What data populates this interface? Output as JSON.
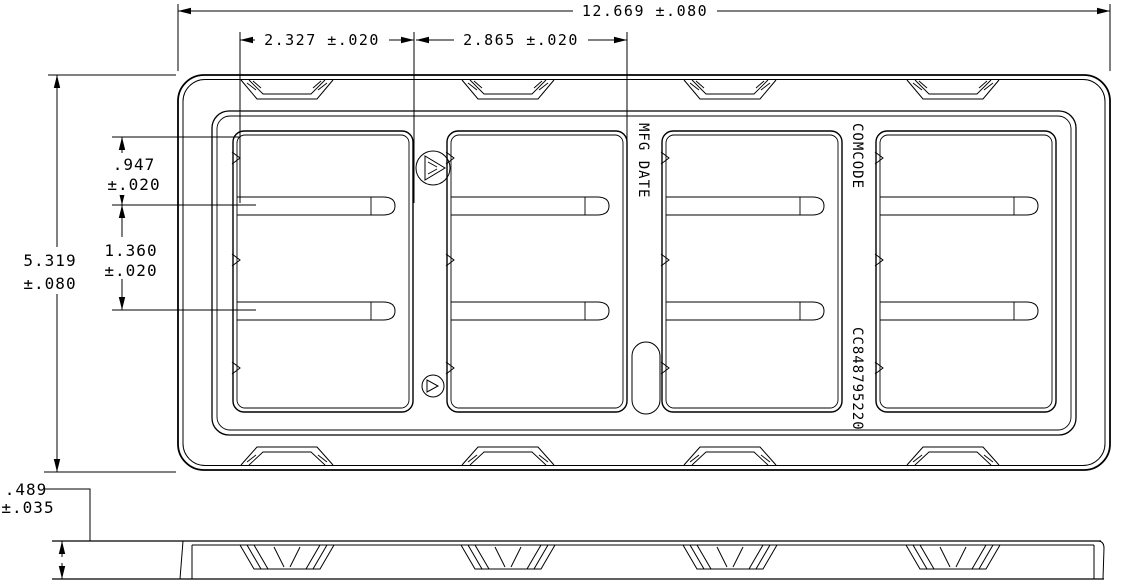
{
  "page": {
    "background": "#ffffff",
    "line_color": "#000000"
  },
  "top_view": {
    "dim_overall_width": "12.669 ±.080",
    "dim_pitch_left": "2.327 ±.020",
    "dim_pitch_right": "2.865 ±.020",
    "dim_pocket_offset": {
      "value": ".947",
      "tol": "±.020"
    },
    "dim_row_pitch": {
      "value": "1.360",
      "tol": "±.020"
    },
    "dim_overall_height": {
      "value": "5.319",
      "tol": "±.080"
    },
    "labels": {
      "mfg_date": "MFG DATE",
      "comcode": "COMCODE",
      "part_number": "CC848795220"
    }
  },
  "side_view": {
    "dim_thickness": {
      "value": ".489",
      "tol": "±.035"
    }
  }
}
